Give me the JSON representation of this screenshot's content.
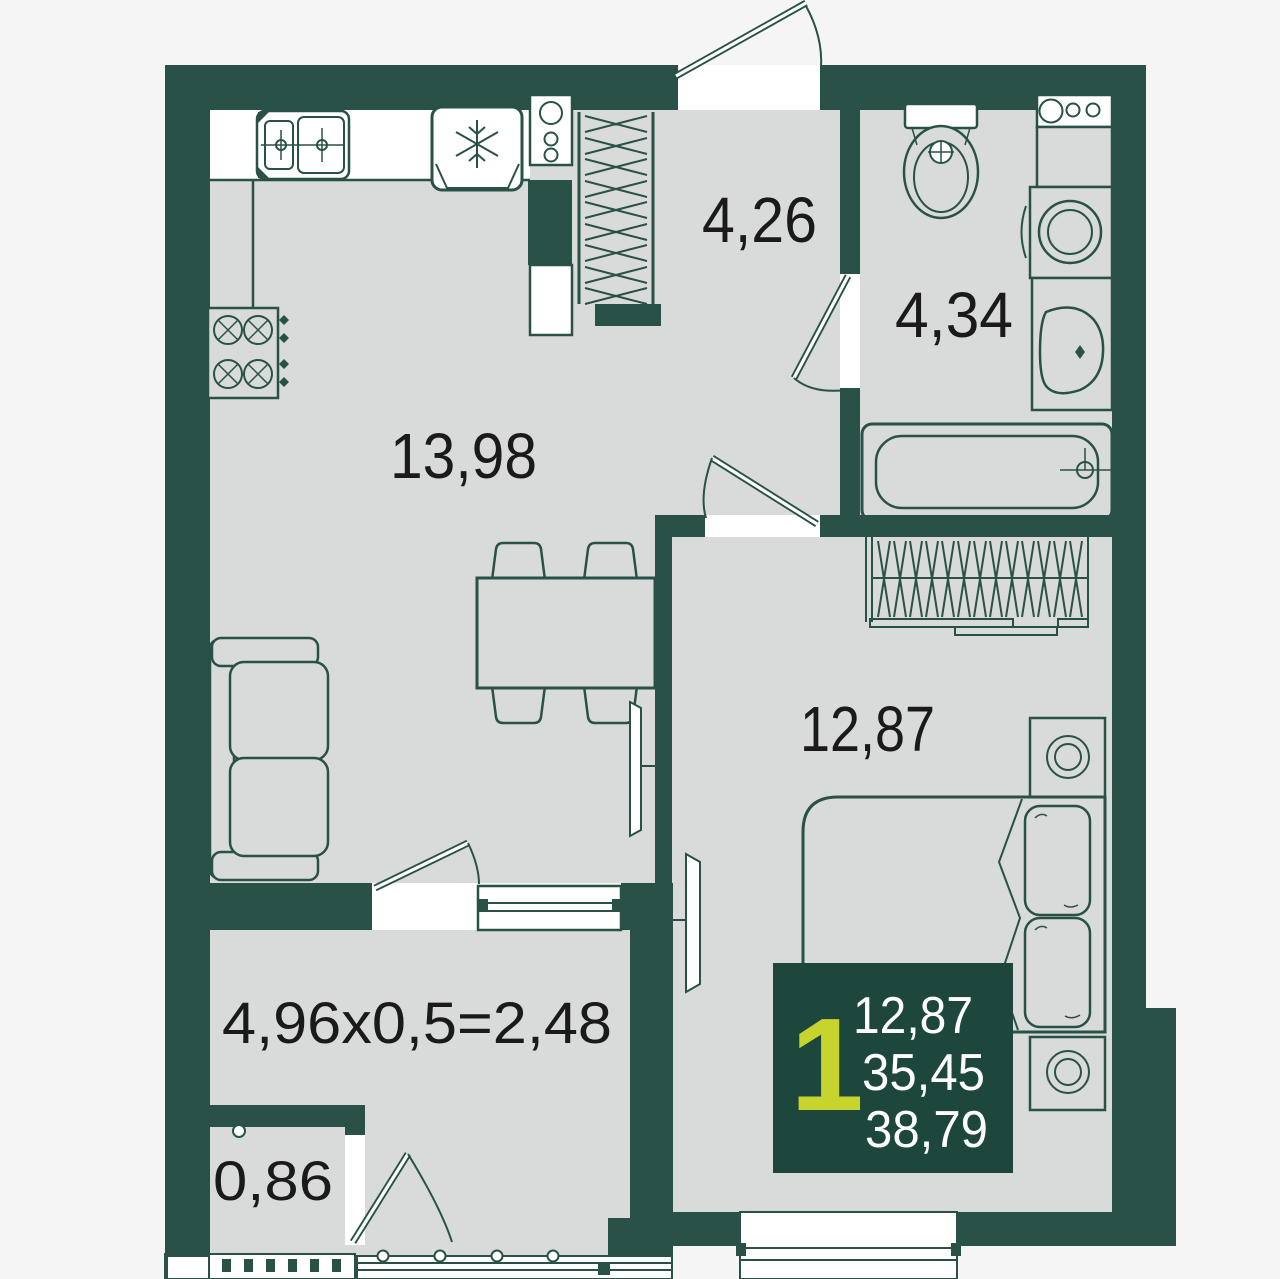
{
  "plan": {
    "title": "1-room apartment floor plan",
    "rooms": [
      {
        "id": "kitchen_living",
        "area_label": "13,98"
      },
      {
        "id": "hallway",
        "area_label": "4,26"
      },
      {
        "id": "bathroom",
        "area_label": "4,34"
      },
      {
        "id": "bedroom",
        "area_label": "12,87"
      },
      {
        "id": "balcony",
        "area_label": "4,96x0,5=2,48"
      },
      {
        "id": "storage",
        "area_label": "0,86"
      }
    ],
    "badge": {
      "rooms_count": "1",
      "room_area": "12,87",
      "living_area": "35,45",
      "total_area": "38,79"
    },
    "colors": {
      "wall": "#295147",
      "floor": "#d8dbd9",
      "badge": "#1d473d",
      "accent_lime": "#c7d42e",
      "text": "#1a1a1a",
      "background": "#f4f5f4",
      "white": "#ffffff"
    }
  }
}
